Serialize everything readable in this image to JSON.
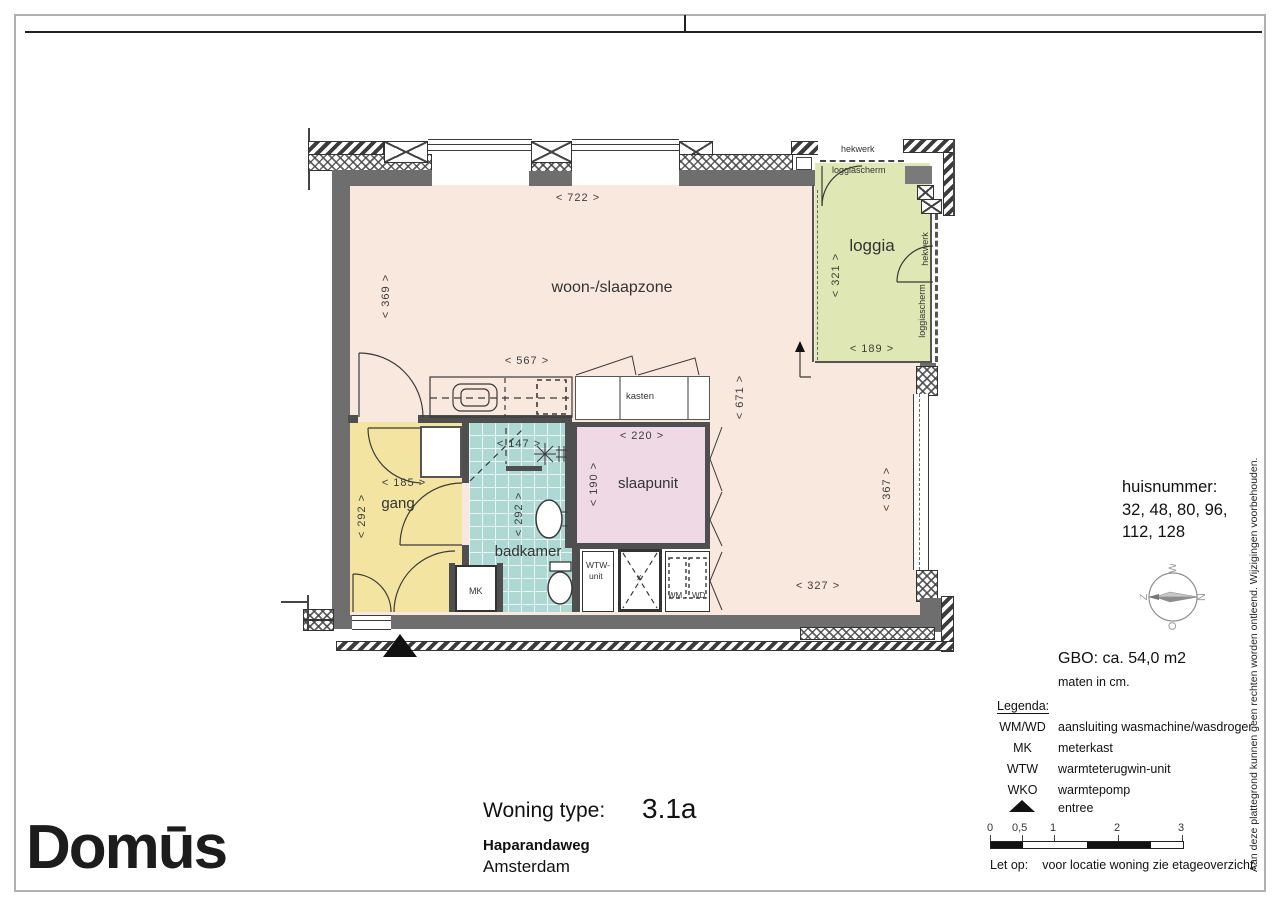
{
  "titleblock": {
    "brand": "Domūs",
    "type_label": "Woning type:",
    "type_value": "3.1a",
    "street": "Haparandaweg",
    "city": "Amsterdam"
  },
  "info": {
    "huisnummer_label": "huisnummer:",
    "huisnummer_line1": "32, 48, 80, 96,",
    "huisnummer_line2": "112, 128",
    "gbo": "GBO: ca. 54,0 m2",
    "units_note": "maten in cm.",
    "legend_title": "Legenda:",
    "legend": {
      "items": [
        {
          "code": "WM/WD",
          "desc": "aansluiting wasmachine/wasdroger"
        },
        {
          "code": "MK",
          "desc": "meterkast"
        },
        {
          "code": "WTW",
          "desc": "warmteterugwin-unit"
        },
        {
          "code": "WKO",
          "desc": "warmtepomp"
        },
        {
          "icon": "entree-triangle",
          "desc": "entree"
        }
      ]
    },
    "scalebar": {
      "labels": [
        "0",
        "0,5",
        "1",
        "2",
        "3"
      ]
    },
    "note_label": "Let op:",
    "note_text": "voor locatie woning zie etageoverzicht.",
    "compass": {
      "north": "N",
      "east": "O",
      "south": "Z",
      "west": "W"
    }
  },
  "disclaimer": "Aan deze plattegrond kunnen geen rechten worden ontleend. Wijzigingen voorbehouden.",
  "plan": {
    "rooms": {
      "living": "woon-/slaapzone",
      "loggia": "loggia",
      "hall": "gang",
      "bathroom": "badkamer",
      "sleep": "slaapunit",
      "closets": "kasten"
    },
    "small_labels": {
      "mk": "MK",
      "wtw_line1": "WTW-",
      "wtw_line2": "unit",
      "wm": "WM",
      "wd": "WD",
      "shaft": "x",
      "hekwerk_top": "hekwerk",
      "loggiascherm_top": "loggiascherm",
      "hekwerk_right": "hekwerk",
      "loggiascherm_right": "loggiascherm"
    },
    "dims": {
      "top": "< 722 >",
      "left": "< 369 >",
      "kitchen": "< 567 >",
      "closet_right": "< 671 >",
      "loggia_h": "< 321 >",
      "loggia_w": "< 189 >",
      "bath_w": "< 147 >",
      "sleep_w": "< 220 >",
      "sleep_h": "< 190 >",
      "hall_w": "< 185 >",
      "hall_h": "< 292 >",
      "bath_h": "< 292 >",
      "right_h": "< 367 >",
      "bottom": "< 327 >"
    },
    "colors": {
      "living": "#f9e8de",
      "loggia": "#dfe7b4",
      "hall": "#f3e4a1",
      "bathroom": "#aed8d4",
      "sleep": "#eed9e5",
      "wall": "#6e6e6e"
    }
  }
}
